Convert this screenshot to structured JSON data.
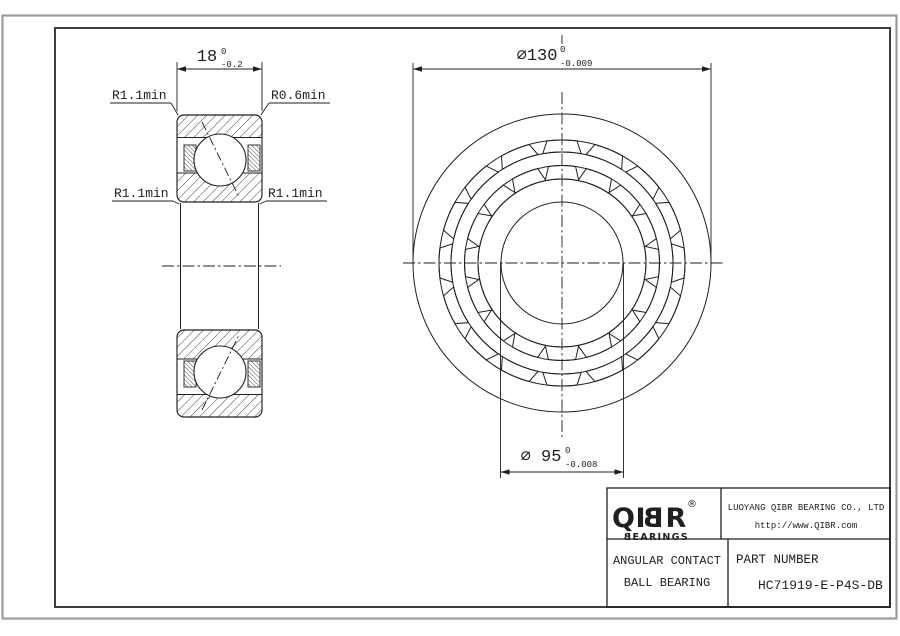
{
  "sheet": {
    "background": "#ffffff",
    "frame_color": "#3d3d3d",
    "outer_border_color": "#9b9b9b",
    "line_color": "#1f1f1f"
  },
  "section_view": {
    "width_dim": {
      "value": "18",
      "tol_upper": "0",
      "tol_lower": "-0.2"
    },
    "fillet_labels": {
      "top_left": "R1.1min",
      "top_right": "R0.6min",
      "mid_left": "R1.1min",
      "mid_right": "R1.1min"
    }
  },
  "front_view": {
    "outer_dim": {
      "value": "⌀130",
      "tol_upper": "0",
      "tol_lower": "-0.009"
    },
    "bore_dim": {
      "value": "⌀ 95",
      "tol_upper": "0",
      "tol_lower": "-0.008"
    },
    "geometry": {
      "center_x": 562,
      "center_y": 263,
      "ring_radii": [
        149,
        123,
        111,
        97.5,
        84,
        61
      ],
      "pocket_count": 16,
      "pocket_start_angle": 90,
      "pocket_bands": [
        {
          "r_out": 123,
          "r_in": 111,
          "half_out": 7,
          "half_in": 10
        },
        {
          "r_out": 97.5,
          "r_in": 84,
          "half_out": 8,
          "half_in": 11.5
        }
      ]
    }
  },
  "title_block": {
    "logo": {
      "part1": "QI",
      "mirrored_b": "B",
      "part2": "R",
      "registered": "®",
      "sub_mirrored_b": "B",
      "sub_rest": "EARINGS"
    },
    "company_name": "LUOYANG QIBR BEARING CO., LTD",
    "website": "http://www.QIBR.com",
    "product_line1": "ANGULAR CONTACT",
    "product_line2": "BALL BEARING",
    "part_number_label": "PART NUMBER",
    "part_number": "HC71919-E-P4S-DB"
  }
}
